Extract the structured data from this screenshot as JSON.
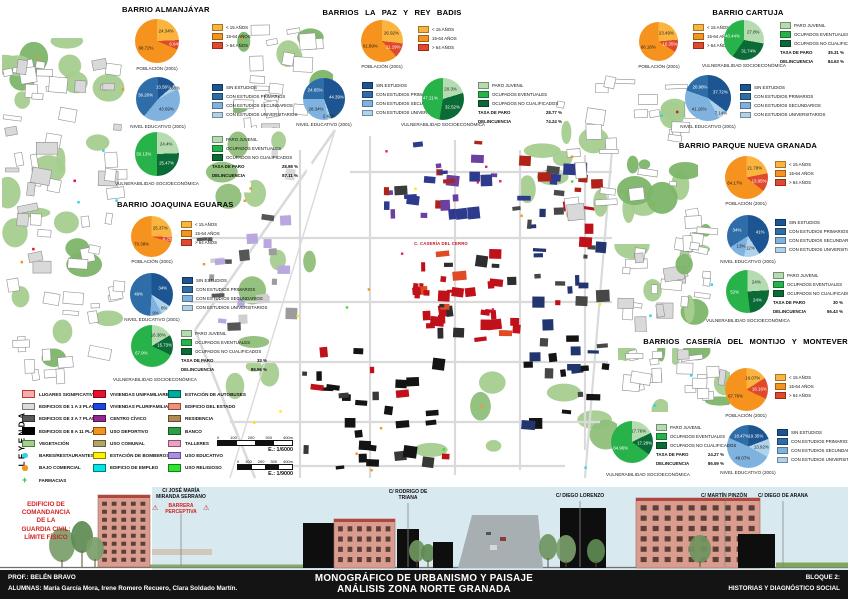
{
  "poster_title": "MONOGRÁFICO DE URBANISMO Y PAISAJE — ANÁLISIS ZONA NORTE GRANADA",
  "map": {
    "street_label": "C. CASERÍA DEL CERRO"
  },
  "barrios": {
    "almanjayar": {
      "title": "BARRIO ALMANJÁYAR",
      "charts": {
        "poblacion": {
          "caption": "POBLACIÓN (2001)",
          "slices": [
            {
              "label": "< 15 AÑOS",
              "value": 24.34,
              "display": "24.34%",
              "color": "#FBB53F"
            },
            {
              "label": "> 64 AÑOS",
              "value": 6.94,
              "display": "6.94%",
              "color": "#E0492C"
            },
            {
              "label": "15-64 AÑOS",
              "value": 68.72,
              "display": "68.72%",
              "color": "#F6921E"
            }
          ],
          "legend_order": [
            0,
            2,
            1
          ]
        },
        "educativo": {
          "caption": "NIVEL EDUCATIVO (2001)",
          "slices": [
            {
              "label": "SIN ESTUDIOS",
              "value": 13.58,
              "display": "13.58%",
              "color": "#1C5592"
            },
            {
              "label": "CON ESTUDIOS UNIVERSITARIOS",
              "value": 3.88,
              "display": "3.88%",
              "color": "#AFD3EA"
            },
            {
              "label": "CON ESTUDIOS SECUNDARIOS",
              "value": 43.69,
              "display": "43.69%",
              "color": "#7FB2DF"
            },
            {
              "label": "CON ESTUDIOS PRIMARIOS",
              "value": 39.26,
              "display": "39.26%",
              "color": "#2E6DA8"
            }
          ],
          "legend_order": [
            0,
            3,
            2,
            1
          ]
        },
        "vulnerabilidad": {
          "caption": "VULNERABILIDAD SOCIOECONÓMICA",
          "slices": [
            {
              "label": "PARO JUVENIL",
              "value": 24.4,
              "display": "24.4%",
              "color": "#B5DCB0"
            },
            {
              "label": "OCUPADOS NO CUALIFICADOS",
              "value": 25.47,
              "display": "25.47%",
              "color": "#0B6B36"
            },
            {
              "label": "OCUPADOS EVENTUALES",
              "value": 50.13,
              "display": "50.13%",
              "color": "#27B24A"
            }
          ],
          "legend_order": [
            0,
            2,
            1
          ],
          "stats": [
            {
              "label": "TASA DE PARO",
              "value": "28.98 %"
            },
            {
              "label": "DELINCUENCIA",
              "value": "87.11 %"
            }
          ]
        }
      }
    },
    "lapaz": {
      "title": "BARRIOS   LA PAZ   Y   REY BADIS",
      "charts": {
        "poblacion": {
          "caption": "POBLACIÓN (2001)",
          "slices": [
            {
              "label": "< 15 AÑOS",
              "value": 26.92,
              "display": "26.92%",
              "color": "#FBB53F"
            },
            {
              "label": "> 64 AÑOS",
              "value": 11.19,
              "display": "11.19%",
              "color": "#E0492C"
            },
            {
              "label": "15-64 AÑOS",
              "value": 61.89,
              "display": "61.89%",
              "color": "#F6921E"
            }
          ],
          "legend_order": [
            0,
            2,
            1
          ]
        },
        "educativo": {
          "caption": "NIVEL EDUCATIVO (2001)",
          "slices": [
            {
              "label": "SIN ESTUDIOS",
              "value": 44.39,
              "display": "44.39%",
              "color": "#1C5592"
            },
            {
              "label": "CON ESTUDIOS UNIVERSITARIOS",
              "value": 2.42,
              "display": "2.42%",
              "color": "#AFD3EA"
            },
            {
              "label": "CON ESTUDIOS SECUNDARIOS",
              "value": 28.34,
              "display": "28.34%",
              "color": "#7FB2DF"
            },
            {
              "label": "CON ESTUDIOS PRIMARIOS",
              "value": 24.85,
              "display": "24.85%",
              "color": "#2E6DA8"
            }
          ],
          "legend_order": [
            0,
            3,
            2,
            1
          ]
        },
        "vulnerabilidad": {
          "caption": "VULNERABILIDAD SOCIOECONÓMICA",
          "slices": [
            {
              "label": "PARO JUVENIL",
              "value": 20.3,
              "display": "20.3%",
              "color": "#B5DCB0"
            },
            {
              "label": "OCUPADOS NO CUALIFICADOS",
              "value": 32.52,
              "display": "32.52%",
              "color": "#0B6B36"
            },
            {
              "label": "OCUPADOS EVENTUALES",
              "value": 47.21,
              "display": "47.21%",
              "color": "#27B24A"
            }
          ],
          "legend_order": [
            0,
            2,
            1
          ],
          "stats": [
            {
              "label": "TASA DE PARO",
              "value": "28.77 %"
            },
            {
              "label": "DELINCUENCIA",
              "value": "74.24 %"
            }
          ]
        }
      }
    },
    "cartuja": {
      "title": "BARRIO CARTUJA",
      "charts": {
        "poblacion": {
          "caption": "POBLACIÓN (2001)",
          "slices": [
            {
              "label": "< 15 AÑOS",
              "value": 23.49,
              "display": "23.49%",
              "color": "#FBB53F"
            },
            {
              "label": "> 64 AÑOS",
              "value": 10.35,
              "display": "10.35%",
              "color": "#E0492C"
            },
            {
              "label": "15-64 AÑOS",
              "value": 66.16,
              "display": "66.16%",
              "color": "#F6921E"
            }
          ],
          "legend_order": [
            0,
            2,
            1
          ]
        },
        "educativo": {
          "caption": "NIVEL EDUCATIVO (2001)",
          "slices": [
            {
              "label": "SIN ESTUDIOS",
              "value": 37.72,
              "display": "37.72%",
              "color": "#1C5592"
            },
            {
              "label": "CON ESTUDIOS UNIVERSITARIOS",
              "value": 7.14,
              "display": "7.14%",
              "color": "#AFD3EA"
            },
            {
              "label": "CON ESTUDIOS SECUNDARIOS",
              "value": 41.16,
              "display": "41.16%",
              "color": "#7FB2DF"
            },
            {
              "label": "CON ESTUDIOS PRIMARIOS",
              "value": 20.98,
              "display": "20.98%",
              "color": "#2E6DA8"
            }
          ],
          "legend_order": [
            0,
            3,
            2,
            1
          ]
        },
        "vulnerabilidad": {
          "caption": "VULNERABILIDAD SOCIOECONÓMICA",
          "slices": [
            {
              "label": "PARO JUVENIL",
              "value": 27.8,
              "display": "27.8%",
              "color": "#B5DCB0"
            },
            {
              "label": "OCUPADOS NO CUALIFICADOS",
              "value": 31.74,
              "display": "31.74%",
              "color": "#0B6B36"
            },
            {
              "label": "OCUPADOS EVENTUALES",
              "value": 40.44,
              "display": "40.44%",
              "color": "#27B24A"
            }
          ],
          "legend_order": [
            0,
            2,
            1
          ],
          "stats": [
            {
              "label": "TASA DE PARO",
              "value": "35.31 %"
            },
            {
              "label": "DELINCUENCIA",
              "value": "84.63 %"
            }
          ]
        }
      }
    },
    "parque": {
      "title": "BARRIO PARQUE NUEVA GRANADA",
      "charts": {
        "poblacion": {
          "caption": "POBLACIÓN (2001)",
          "slices": [
            {
              "label": "< 15 AÑOS",
              "value": 21.78,
              "display": "21.78%",
              "color": "#FBB53F"
            },
            {
              "label": "> 64 AÑOS",
              "value": 13.95,
              "display": "13.95%",
              "color": "#E0492C"
            },
            {
              "label": "15-64 AÑOS",
              "value": 64.17,
              "display": "64.17%",
              "color": "#F6921E"
            }
          ],
          "legend_order": [
            0,
            2,
            1
          ]
        },
        "educativo": {
          "caption": "NIVEL EDUCATIVO (2001)",
          "slices": [
            {
              "label": "SIN ESTUDIOS",
              "value": 41,
              "display": "41%",
              "color": "#1C5592"
            },
            {
              "label": "CON ESTUDIOS UNIVERSITARIOS",
              "value": 12,
              "display": "12%",
              "color": "#AFD3EA"
            },
            {
              "label": "CON ESTUDIOS SECUNDARIOS",
              "value": 13,
              "display": "13%",
              "color": "#7FB2DF"
            },
            {
              "label": "CON ESTUDIOS PRIMARIOS",
              "value": 34,
              "display": "34%",
              "color": "#2E6DA8"
            }
          ],
          "legend_order": [
            0,
            3,
            2,
            1
          ]
        },
        "vulnerabilidad": {
          "caption": "VULNERABILIDAD SOCIOECONÓMICA",
          "slices": [
            {
              "label": "PARO JUVENIL",
              "value": 24,
              "display": "24%",
              "color": "#B5DCB0"
            },
            {
              "label": "OCUPADOS NO CUALIFICADOS",
              "value": 24,
              "display": "24%",
              "color": "#0B6B36"
            },
            {
              "label": "OCUPADOS EVENTUALES",
              "value": 52,
              "display": "52%",
              "color": "#27B24A"
            }
          ],
          "legend_order": [
            0,
            2,
            1
          ],
          "stats": [
            {
              "label": "TASA DE PARO",
              "value": "30 %"
            },
            {
              "label": "DELINCUENCIA",
              "value": "56.43 %"
            }
          ]
        }
      }
    },
    "joaquina": {
      "title": "BARRIO JOAQUINA EGUARAS",
      "charts": {
        "poblacion": {
          "caption": "POBLACIÓN (2001)",
          "slices": [
            {
              "label": "< 15 AÑOS",
              "value": 25.37,
              "display": "25.37%",
              "color": "#FBB53F"
            },
            {
              "label": "> 64 AÑOS",
              "value": 4.25,
              "display": "4.25%",
              "color": "#E0492C"
            },
            {
              "label": "15-64 AÑOS",
              "value": 70.38,
              "display": "70.38%",
              "color": "#F6921E"
            }
          ],
          "legend_order": [
            0,
            2,
            1
          ]
        },
        "educativo": {
          "caption": "NIVEL EDUCATIVO (2001)",
          "slices": [
            {
              "label": "SIN ESTUDIOS",
              "value": 34,
              "display": "34%",
              "color": "#1C5592"
            },
            {
              "label": "CON ESTUDIOS UNIVERSITARIOS",
              "value": 8,
              "display": "8%",
              "color": "#AFD3EA"
            },
            {
              "label": "CON ESTUDIOS SECUNDARIOS",
              "value": 9,
              "display": "9%",
              "color": "#7FB2DF"
            },
            {
              "label": "CON ESTUDIOS PRIMARIOS",
              "value": 49,
              "display": "49%",
              "color": "#2E6DA8"
            }
          ],
          "legend_order": [
            0,
            3,
            2,
            1
          ]
        },
        "vulnerabilidad": {
          "caption": "VULNERABILIDAD SOCIOECONÓMICA",
          "slices": [
            {
              "label": "PARO JUVENIL",
              "value": 16.38,
              "display": "16.38%",
              "color": "#B5DCB0"
            },
            {
              "label": "OCUPADOS NO CUALIFICADOS",
              "value": 15.73,
              "display": "15.73%",
              "color": "#0B6B36"
            },
            {
              "label": "OCUPADOS EVENTUALES",
              "value": 67.9,
              "display": "67.9%",
              "color": "#27B24A"
            }
          ],
          "legend_order": [
            0,
            2,
            1
          ],
          "stats": [
            {
              "label": "TASA DE PARO",
              "value": "33 %"
            },
            {
              "label": "DELINCUENCIA",
              "value": "86.56 %"
            }
          ]
        }
      }
    },
    "monteverde": {
      "title": "BARRIOS   CASERÍA DEL MONTIJO   Y   MONTEVERDE",
      "charts": {
        "poblacion": {
          "caption": "POBLACIÓN (2001)",
          "slices": [
            {
              "label": "< 15 AÑOS",
              "value": 16.07,
              "display": "16.07%",
              "color": "#FBB53F"
            },
            {
              "label": "> 64 AÑOS",
              "value": 16.16,
              "display": "16.16%",
              "color": "#E0492C"
            },
            {
              "label": "15-64 AÑOS",
              "value": 67.76,
              "display": "67.76%",
              "color": "#F6921E"
            }
          ],
          "legend_order": [
            0,
            2,
            1
          ]
        },
        "educativo": {
          "caption": "NIVEL EDUCATIVO (2001)",
          "slices": [
            {
              "label": "SIN ESTUDIOS",
              "value": 19.35,
              "display": "19.35%",
              "color": "#1C5592"
            },
            {
              "label": "CON ESTUDIOS UNIVERSITARIOS",
              "value": 13.92,
              "display": "13.92%",
              "color": "#AFD3EA"
            },
            {
              "label": "CON ESTUDIOS SECUNDARIOS",
              "value": 49.07,
              "display": "49.07%",
              "color": "#7FB2DF"
            },
            {
              "label": "CON ESTUDIOS PRIMARIOS",
              "value": 18.47,
              "display": "18.47%",
              "color": "#2E6DA8"
            }
          ],
          "legend_order": [
            0,
            3,
            2,
            1
          ]
        },
        "vulnerabilidad": {
          "caption": "VULNERABILIDAD SOCIOECONÓMICA",
          "slices": [
            {
              "label": "PARO JUVENIL",
              "value": 17.76,
              "display": "17.76%",
              "color": "#B5DCB0"
            },
            {
              "label": "OCUPADOS NO CUALIFICADOS",
              "value": 17.28,
              "display": "17.28%",
              "color": "#0B6B36"
            },
            {
              "label": "OCUPADOS EVENTUALES",
              "value": 64.96,
              "display": "64.96%",
              "color": "#27B24A"
            }
          ],
          "legend_order": [
            0,
            2,
            1
          ],
          "stats": [
            {
              "label": "TASA DE PARO",
              "value": "24.27 %"
            },
            {
              "label": "DELINCUENCIA",
              "value": "86.59 %"
            }
          ]
        }
      }
    }
  },
  "legend": {
    "title": "LEYENDA",
    "col1": [
      {
        "label": "LUGARES SIGNIFICATIVOS",
        "color": "#F2AFAD",
        "shape": "rect",
        "border": "#C0392B"
      },
      {
        "label": "EDIFICIOS DE 1 A 3 PLANTAS",
        "color": "#DCDCDC",
        "shape": "rect"
      },
      {
        "label": "EDIFICIOS DE 3 A 7 PLANTAS",
        "color": "#595959",
        "shape": "rect"
      },
      {
        "label": "EDIFICIOS DE 8 A 11 PLANTAS",
        "color": "#000000",
        "shape": "rect"
      },
      {
        "label": "VEGETACIÓN",
        "color": "#A5CE90",
        "shape": "rect",
        "border": "#4E7A3A"
      },
      {
        "label": "BARES/RESTAURANTES",
        "color": "#2FD4E6",
        "shape": "circle"
      },
      {
        "label": "BAJO COMERCIAL",
        "color": "#F6921E",
        "shape": "circle"
      },
      {
        "label": "FARMACIAS",
        "color": "#39B54A",
        "shape": "cross"
      }
    ],
    "col2": [
      {
        "label": "VIVIENDAS UNIFAMILIARES",
        "color": "#E8112D",
        "shape": "rect"
      },
      {
        "label": "VIVIENDAS PLURIFAMILIARES",
        "color": "#1B46E0",
        "shape": "rect"
      },
      {
        "label": "CENTRO CÍVICO",
        "color": "#92278F",
        "shape": "rect"
      },
      {
        "label": "USO DEPORTIVO",
        "color": "#F6921E",
        "shape": "rect"
      },
      {
        "label": "USO COMUNAL",
        "color": "#B3A269",
        "shape": "rect"
      },
      {
        "label": "ESTACIÓN DE BOMBEROS",
        "color": "#FFF200",
        "shape": "rect"
      },
      {
        "label": "EDIFICIO DE EMPLEO",
        "color": "#00E5E5",
        "shape": "rect"
      }
    ],
    "col3": [
      {
        "label": "ESTACIÓN DE AUTOBUSES",
        "color": "#00A99D",
        "shape": "rect"
      },
      {
        "label": "EDIFICIO DEL ESTADO",
        "color": "#F2907B",
        "shape": "rect"
      },
      {
        "label": "RESIDENCIA",
        "color": "#B08954",
        "shape": "rect"
      },
      {
        "label": "BANCO",
        "color": "#2E9E44",
        "shape": "rect"
      },
      {
        "label": "TALLERES",
        "color": "#F2A0C0",
        "shape": "rect"
      },
      {
        "label": "USO EDUCATIVO",
        "color": "#A98FE8",
        "shape": "rect"
      },
      {
        "label": "USO RELIGIOSO",
        "color": "#2EE52E",
        "shape": "rect"
      }
    ],
    "scales": [
      {
        "ticks": [
          "0",
          "100",
          "200",
          "300",
          "400m"
        ],
        "label": "E.: 1/6000"
      },
      {
        "ticks": [
          "0",
          "100",
          "200",
          "300",
          "400m"
        ],
        "label": "E.: 1/9000"
      }
    ]
  },
  "strip": {
    "comandancia": "EDIFICIO DE\nCOMANDANCIA\nDE LA\nGUARDIA CIVIL:\nLÍMITE FÍSICO",
    "barrera": "BARRERA\nPERCEPTIVA",
    "warning_icon": "⚠",
    "streets": [
      "C/ JOSÉ MARÍA\nMIRANDA SERRANO",
      "C/ RODRIGO DE\nTRIANA",
      "C/ DIEGO LORENZO",
      "C/ MARTÍN PINZÓN",
      "C/ DIEGO DE ARANA"
    ]
  },
  "footer": {
    "prof": "PROF.: BELÉN BRAVO",
    "alumnas": "ALUMNAS: María García Mora, Irene Romero Recuero, Clara Soldado Martín.",
    "title1": "MONOGRÁFICO DE URBANISMO Y PAISAJE",
    "title2": "ANÁLISIS ZONA NORTE GRANADA",
    "block1": "BLOQUE 2:",
    "block2": "HISTORIAS Y DIAGNÓSTICO SOCIAL"
  }
}
